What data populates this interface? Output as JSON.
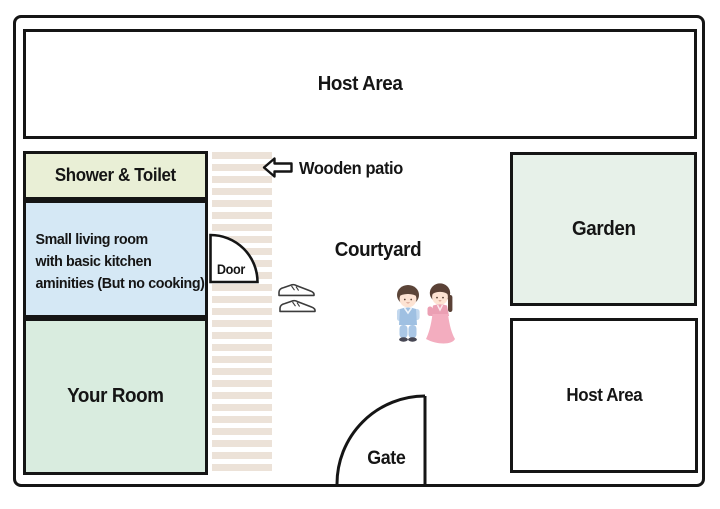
{
  "floorplan": {
    "rooms": {
      "host_area_top": {
        "label": "Host Area",
        "fill": "#ffffff"
      },
      "shower_toilet": {
        "label": "Shower & Toilet",
        "fill": "#e9efd6"
      },
      "living_room": {
        "lines": [
          "Small living room",
          "with basic kitchen",
          "aminities (But no cooking)"
        ],
        "fill": "#d5e8f5"
      },
      "your_room": {
        "label": "Your Room",
        "fill": "#d9ecdf"
      },
      "garden": {
        "label": "Garden",
        "fill": "#e7f1e9"
      },
      "host_area_bottom": {
        "label": "Host Area",
        "fill": "#ffffff"
      }
    },
    "annotations": {
      "wooden_patio": {
        "label": "Wooden patio"
      },
      "courtyard": {
        "label": "Courtyard"
      },
      "door": {
        "label": "Door"
      },
      "gate": {
        "label": "Gate"
      }
    },
    "icons": {
      "left_arrow": "left-arrow-icon",
      "shoes": "shoes-icon",
      "couple": "hanbok-couple-icon"
    },
    "colors": {
      "outline": "#151515",
      "patio_stripe": "#ece2d8",
      "shower_fill": "#e9efd6",
      "living_fill": "#d5e8f5",
      "your_room_fill": "#d9ecdf",
      "garden_fill": "#e7f1e9",
      "boy_blue": "#a9c6e4",
      "girl_pink": "#f2a7ba",
      "skin": "#fde3d3",
      "hair_brown": "#5b4438"
    }
  }
}
